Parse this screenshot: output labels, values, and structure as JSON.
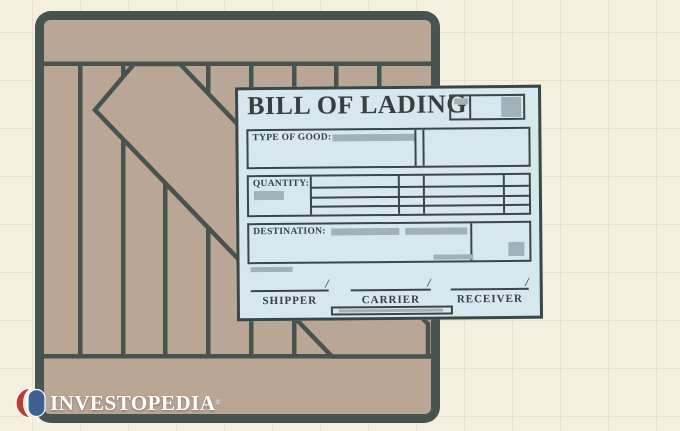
{
  "scene": {
    "description_colors": {
      "background": "#f4f0dd",
      "grid_line": "#e8e2cc",
      "crate_plank": "#b9a694",
      "crate_outline": "#46534f",
      "paper": "#d6e7ed",
      "ink": "#3a4747",
      "placeholder_bar": "#a1b1b9"
    }
  },
  "document": {
    "title": "BILL OF LADING",
    "fields": {
      "type_of_good_label": "TYPE OF GOOD:",
      "quantity_label": "QUANTITY:",
      "destination_label": "DESTINATION:"
    },
    "signatures": [
      {
        "label": "SHIPPER",
        "slash": "/"
      },
      {
        "label": "CARRIER",
        "slash": "/"
      },
      {
        "label": "RECEIVER",
        "slash": "/"
      }
    ]
  },
  "logo": {
    "text": "INVESTOPEDIA",
    "registered": "®",
    "red": "#bf3a31",
    "blue": "#3e618f",
    "text_color": "#ffffff"
  }
}
